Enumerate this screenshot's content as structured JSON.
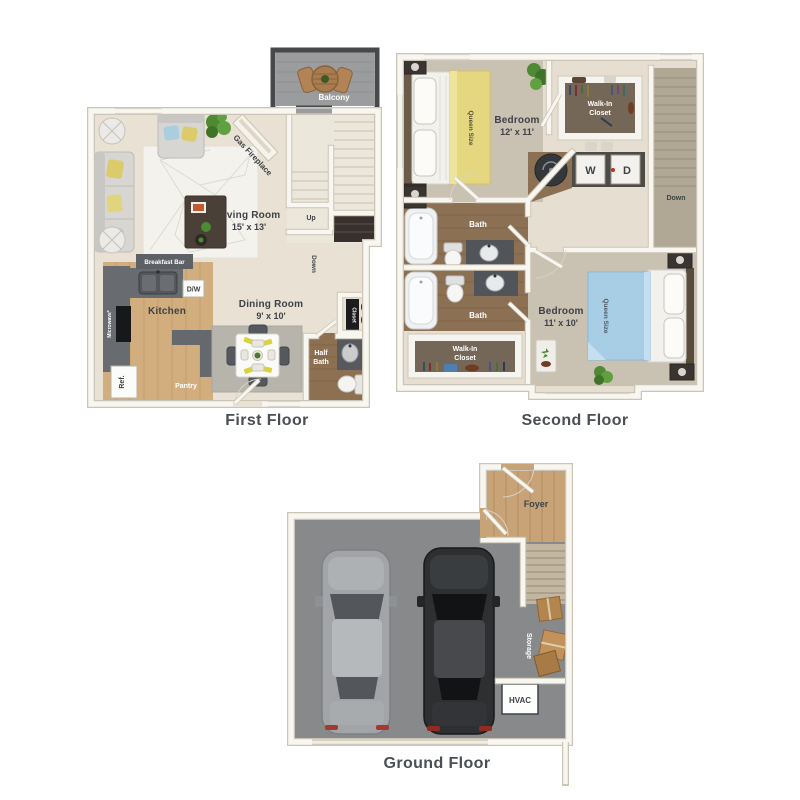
{
  "palette": {
    "background": "#ffffff",
    "wall_white": "#f8f6f0",
    "wall_outline": "#ccc5b6",
    "floor_cream": "#e9e2d4",
    "floor_taupe": "#c9c1b2",
    "floor_wood_kitchen": "#d2ae7e",
    "floor_wood_bath": "#8b7053",
    "floor_foyer": "#c7a377",
    "garage_gray": "#87898b",
    "balcony_gray": "#9a9c9d",
    "counter_gray": "#63676b",
    "closet_dark": "#756757",
    "bed_yellow": "#e5d77f",
    "bed_blue": "#a8cee5",
    "plant_green": "#4e8a33",
    "text_dark": "#3e4247"
  },
  "first_floor": {
    "label": "First Floor",
    "balcony": "Balcony",
    "fireplace": "Gas Fireplace",
    "living_room": {
      "name": "Living Room",
      "dims": "15' x 13'"
    },
    "dining_room": {
      "name": "Dining Room",
      "dims": "9' x 10'"
    },
    "kitchen": {
      "name": "Kitchen",
      "breakfast_bar": "Breakfast Bar",
      "dishwasher": "D/W",
      "microwave": "Microwave*",
      "refrigerator": "Ref.",
      "pantry": "Pantry"
    },
    "closet": "Closet",
    "half_bath": {
      "line1": "Half",
      "line2": "Bath"
    },
    "stairs": {
      "up": "Up",
      "down": "Down"
    }
  },
  "second_floor": {
    "label": "Second Floor",
    "bedroom_1": {
      "name": "Bedroom",
      "dims": "12' x 11'",
      "bed": "Queen Size"
    },
    "bedroom_2": {
      "name": "Bedroom",
      "dims": "11' x 10'",
      "bed": "Queen Size"
    },
    "walk_in_closet_1": {
      "line1": "Walk-In",
      "line2": "Closet"
    },
    "walk_in_closet_2": {
      "line1": "Walk-In",
      "line2": "Closet"
    },
    "bath_1": "Bath",
    "bath_2": "Bath",
    "laundry": {
      "washer": "W",
      "dryer": "D"
    },
    "stairs": {
      "down": "Down"
    }
  },
  "ground_floor": {
    "label": "Ground Floor",
    "foyer": "Foyer",
    "storage": "Storage",
    "hvac": "HVAC"
  }
}
